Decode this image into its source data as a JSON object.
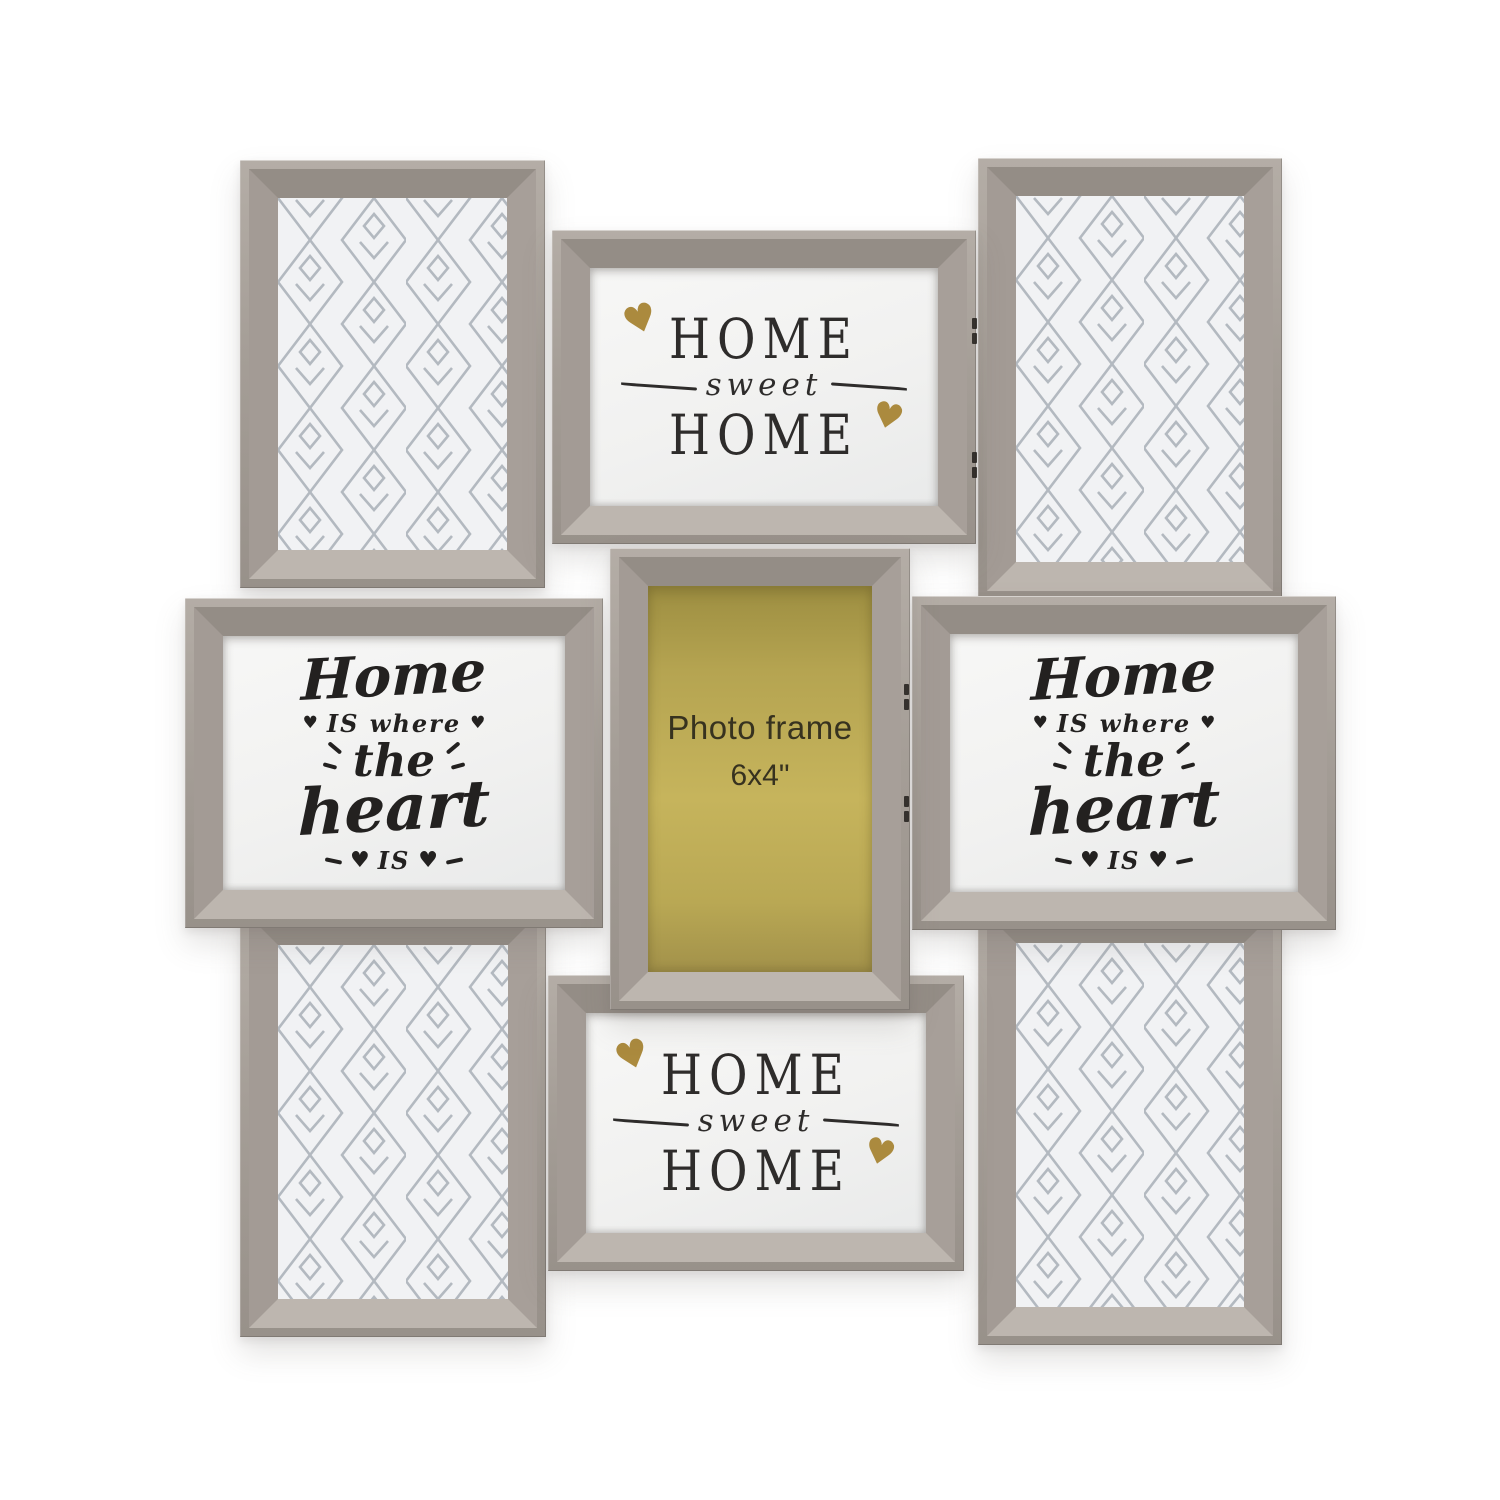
{
  "canvas": {
    "background": "#ffffff"
  },
  "palette": {
    "frame_grey": "#a39c95",
    "frame_bevel_dark": "#948d86",
    "frame_bevel_light": "#bdb6af",
    "gold_heart": "#ab8a3e",
    "insert_yellow": "#c6b45c",
    "text_black": "#2e2c2b",
    "lattice_line": "#b3b9c0",
    "lattice_bg": "#f1f2f4"
  },
  "glyphs": {
    "heart": "♥"
  },
  "texts": {
    "home_sweet_home": {
      "top": "HOME",
      "middle": "sweet",
      "bottom": "HOME"
    },
    "home_is_where": {
      "home": "Home",
      "is_where": "IS where",
      "the": "the",
      "heart": "heart",
      "is": "IS"
    },
    "center_insert": {
      "line1": "Photo frame",
      "line2": "6x4\""
    }
  }
}
